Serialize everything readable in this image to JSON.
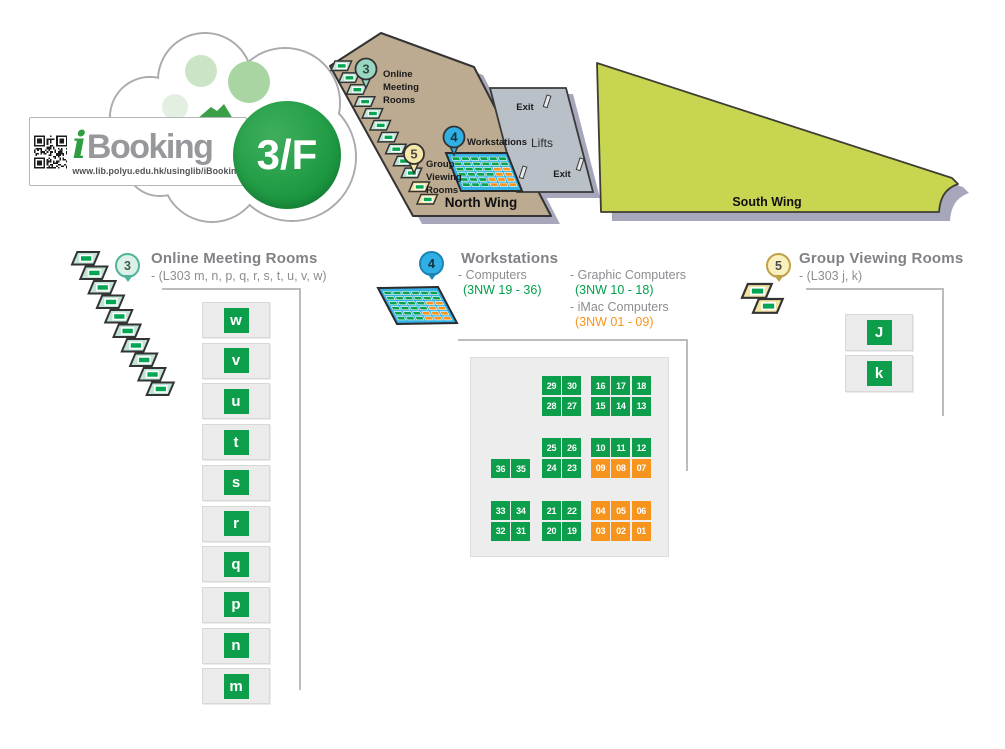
{
  "logo": {
    "brand_i": "i",
    "brand_name": "Booking",
    "url": "www.lib.polyu.edu.hk/usinglib/iBooking",
    "floor": "3/F"
  },
  "map": {
    "north_wing": "North Wing",
    "south_wing": "South Wing",
    "lifts": "Lifts",
    "exit_top": "Exit",
    "exit_bottom": "Exit",
    "marker3": {
      "number": "3",
      "lines": [
        "Online",
        "Meeting",
        "Rooms"
      ]
    },
    "marker4": {
      "number": "4",
      "label": "Workstations"
    },
    "marker5": {
      "number": "5",
      "lines": [
        "Group",
        "Viewing",
        "Rooms"
      ]
    }
  },
  "sections": {
    "online_meeting": {
      "marker": "3",
      "title": "Online Meeting Rooms",
      "subtitle": "- (L303 m, n, p, q, r, s, t, u, v, w)",
      "rooms": [
        "w",
        "v",
        "u",
        "t",
        "s",
        "r",
        "q",
        "p",
        "n",
        "m"
      ]
    },
    "workstations": {
      "marker": "4",
      "title": "Workstations",
      "legend": [
        {
          "label": "- Computers",
          "range": "(3NW 19 - 36)",
          "color": "green"
        },
        {
          "label": "- Graphic Computers",
          "range": "(3NW 10 - 18)",
          "color": "green"
        },
        {
          "label": "- iMac Computers",
          "range": "(3NW 01 - 09)",
          "color": "orange"
        }
      ],
      "clusters": [
        {
          "left": 541,
          "top": 375,
          "cols": 2,
          "seats": [
            {
              "n": "29",
              "c": "g"
            },
            {
              "n": "30",
              "c": "g"
            },
            {
              "n": "28",
              "c": "g"
            },
            {
              "n": "27",
              "c": "g"
            }
          ]
        },
        {
          "left": 590,
          "top": 375,
          "cols": 3,
          "seats": [
            {
              "n": "16",
              "c": "g"
            },
            {
              "n": "17",
              "c": "g"
            },
            {
              "n": "18",
              "c": "g"
            },
            {
              "n": "15",
              "c": "g"
            },
            {
              "n": "14",
              "c": "g"
            },
            {
              "n": "13",
              "c": "g"
            }
          ]
        },
        {
          "left": 490,
          "top": 458,
          "cols": 2,
          "seats": [
            {
              "n": "36",
              "c": "g"
            },
            {
              "n": "35",
              "c": "g"
            }
          ]
        },
        {
          "left": 541,
          "top": 437,
          "cols": 2,
          "seats": [
            {
              "n": "25",
              "c": "g"
            },
            {
              "n": "26",
              "c": "g"
            },
            {
              "n": "24",
              "c": "g"
            },
            {
              "n": "23",
              "c": "g"
            }
          ]
        },
        {
          "left": 590,
          "top": 437,
          "cols": 3,
          "seats": [
            {
              "n": "10",
              "c": "g"
            },
            {
              "n": "11",
              "c": "g"
            },
            {
              "n": "12",
              "c": "g"
            },
            {
              "n": "09",
              "c": "o"
            },
            {
              "n": "08",
              "c": "o"
            },
            {
              "n": "07",
              "c": "o"
            }
          ]
        },
        {
          "left": 490,
          "top": 500,
          "cols": 2,
          "seats": [
            {
              "n": "33",
              "c": "g"
            },
            {
              "n": "34",
              "c": "g"
            },
            {
              "n": "32",
              "c": "g"
            },
            {
              "n": "31",
              "c": "g"
            }
          ]
        },
        {
          "left": 541,
          "top": 500,
          "cols": 2,
          "seats": [
            {
              "n": "21",
              "c": "g"
            },
            {
              "n": "22",
              "c": "g"
            },
            {
              "n": "20",
              "c": "g"
            },
            {
              "n": "19",
              "c": "g"
            }
          ]
        },
        {
          "left": 590,
          "top": 500,
          "cols": 3,
          "seats": [
            {
              "n": "04",
              "c": "o"
            },
            {
              "n": "05",
              "c": "o"
            },
            {
              "n": "06",
              "c": "o"
            },
            {
              "n": "03",
              "c": "o"
            },
            {
              "n": "02",
              "c": "o"
            },
            {
              "n": "01",
              "c": "o"
            }
          ]
        }
      ]
    },
    "group_viewing": {
      "marker": "5",
      "title": "Group Viewing Rooms",
      "subtitle": "- (L303 j, k)",
      "rooms": [
        "J",
        "k"
      ]
    }
  },
  "colors": {
    "seat_green": "#0c9e4a",
    "seat_orange": "#f7941e",
    "green_text": "#00a04a",
    "orange_text": "#f7941d",
    "workstation_blue": "#35b3e6",
    "teal_pin": "#9ad7c3",
    "yellow_pin": "#f6e8a9",
    "north_wing_tan": "#bcab90",
    "south_wing_green": "#c8d550",
    "lifts_gray": "#b9c0c8",
    "shadow_gray": "#a6a7bb",
    "title_gray": "#7f8184"
  }
}
